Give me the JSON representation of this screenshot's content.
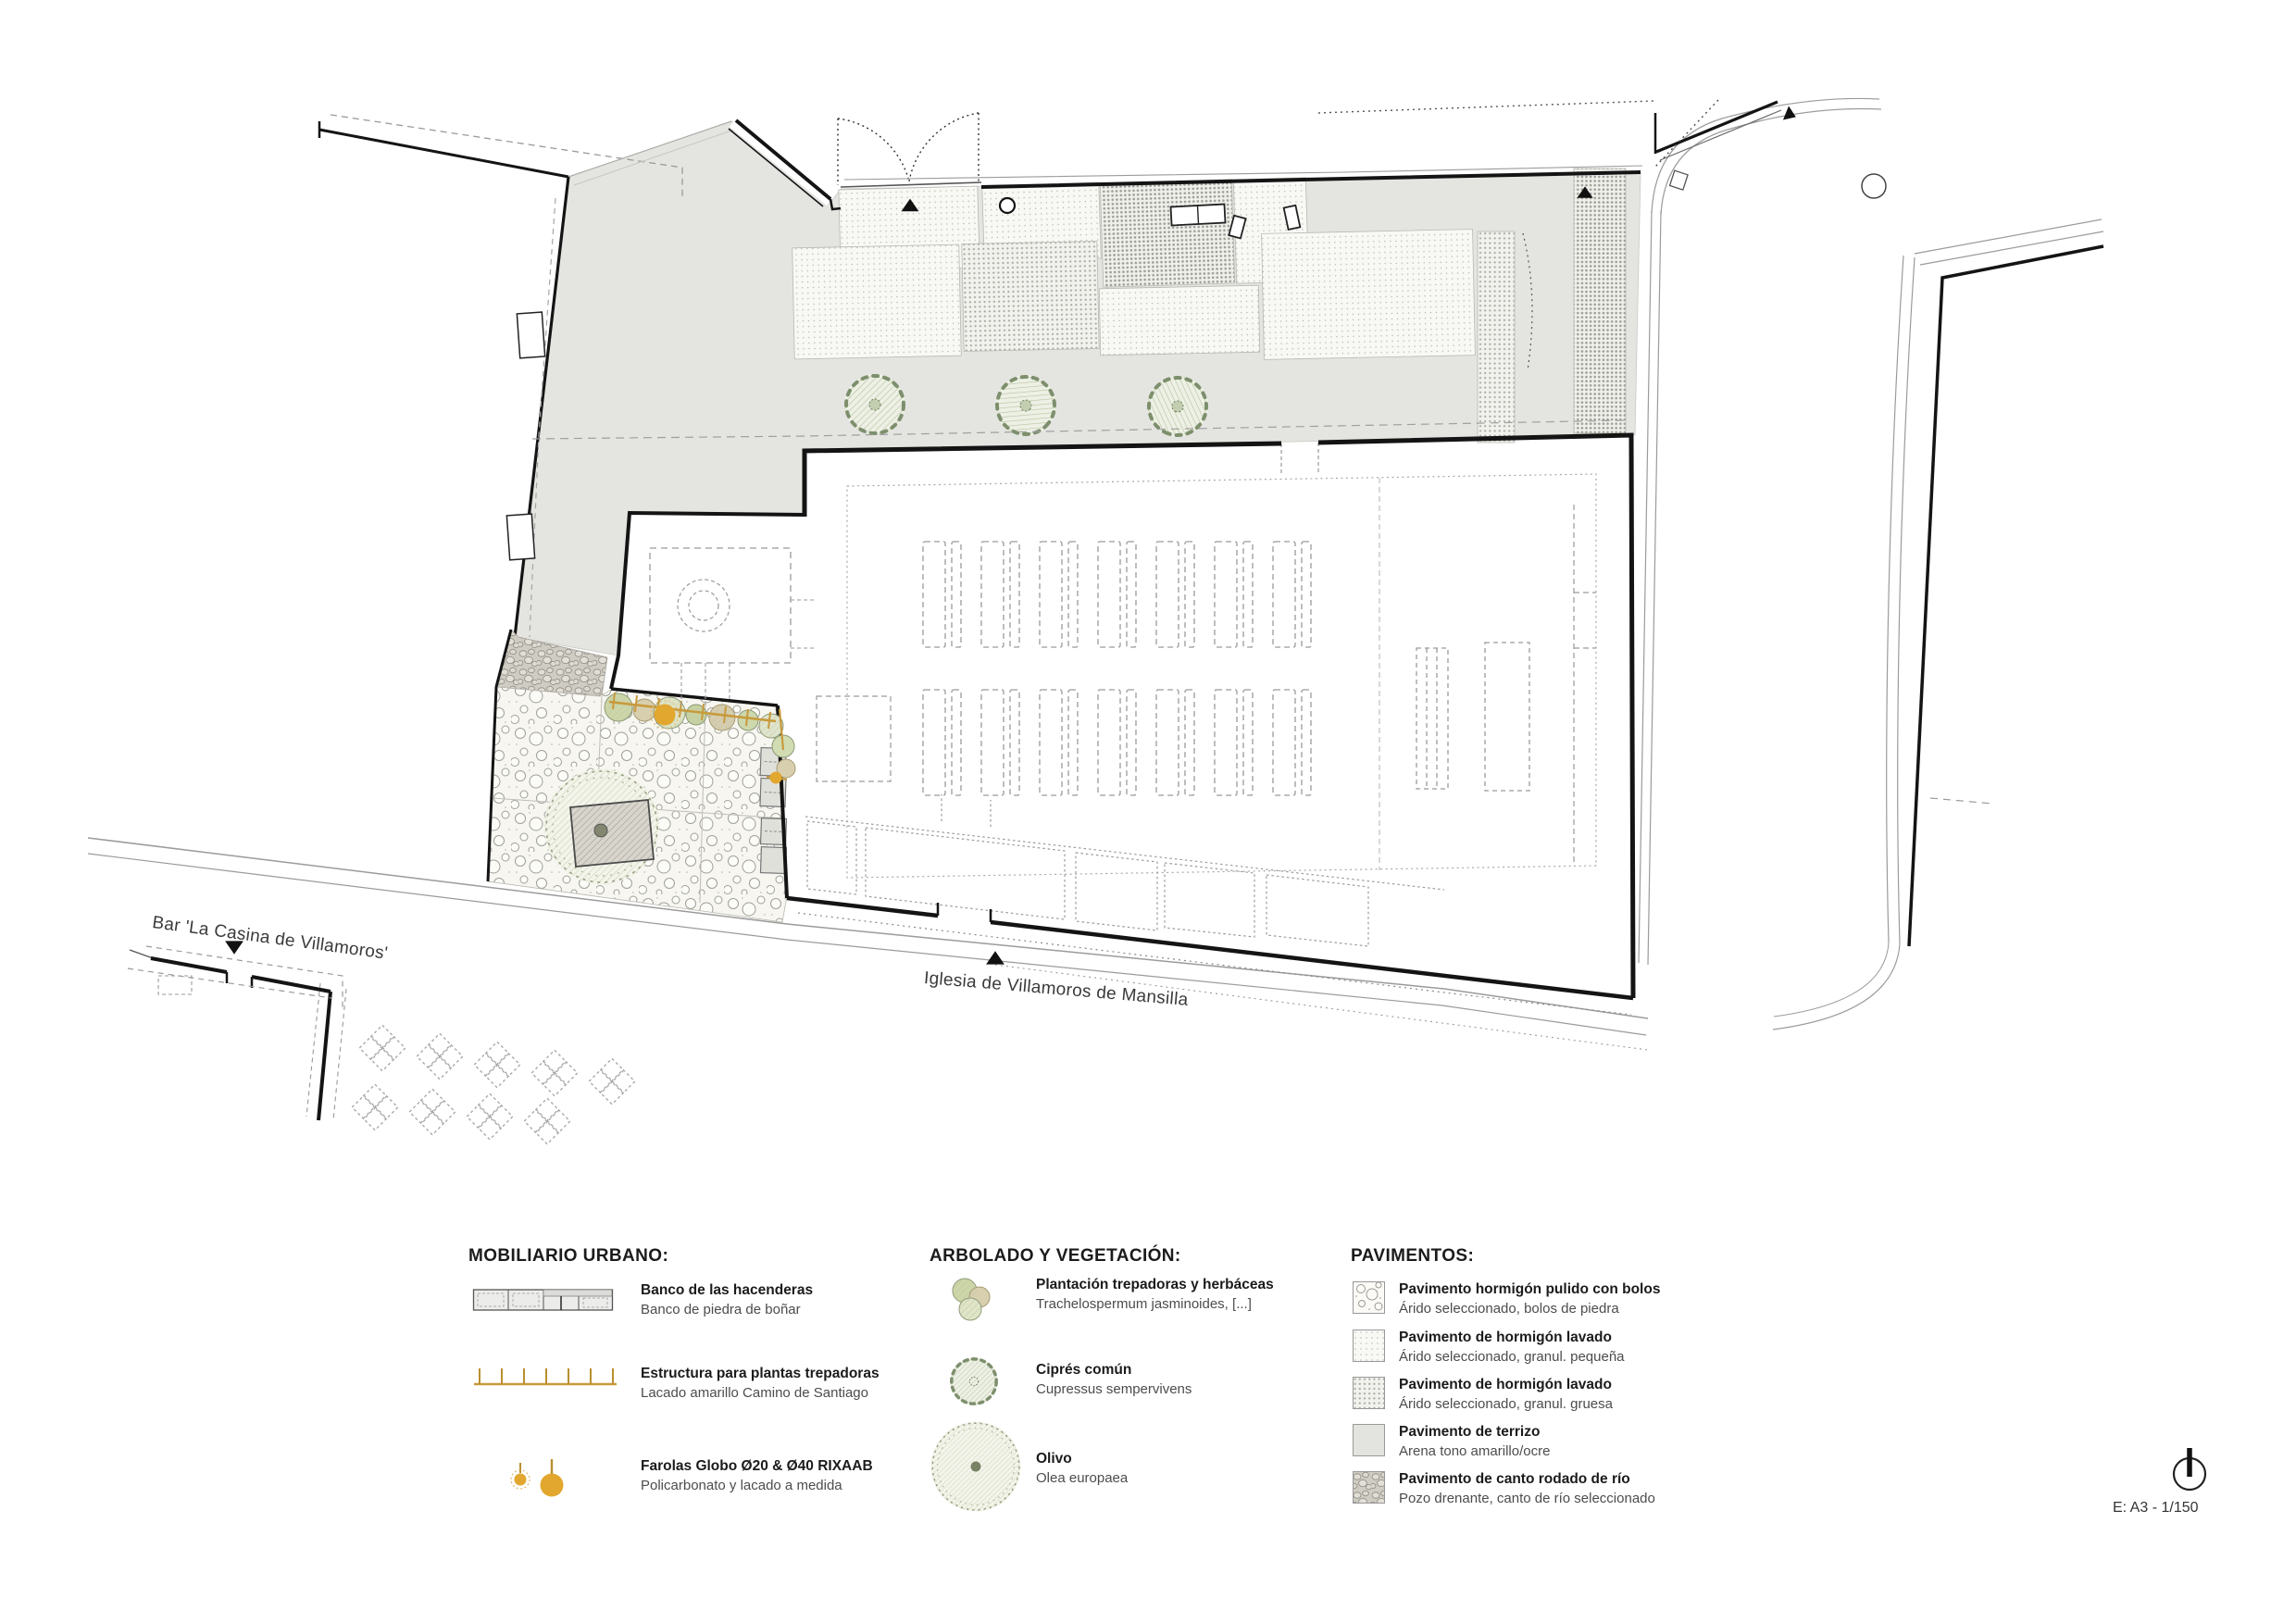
{
  "plan": {
    "labels": {
      "bar": "Bar 'La Casina de Villamoros'",
      "church": "Iglesia de Villamoros de Mansilla"
    },
    "scale_note": "E: A3 - 1/150",
    "features": {
      "church_building": "iglesia planta",
      "pebble_plaza": "plaza canto rodado",
      "courtyard": "atrio pavimentado",
      "bar_building": "bar",
      "north_arrow": "norte"
    }
  },
  "legend": {
    "mobiliario": {
      "title": "MOBILIARIO URBANO:",
      "items": [
        {
          "title": "Banco de las hacenderas",
          "subtitle": "Banco de piedra de boñar",
          "icon": "stone-bench-plan-icon"
        },
        {
          "title": "Estructura para plantas trepadoras",
          "subtitle": "Lacado amarillo Camino de Santiago",
          "icon": "climber-trellis-icon"
        },
        {
          "title": "Farolas Globo Ø20 & Ø40 RIXAAB",
          "subtitle": "Policarbonato y lacado a medida",
          "icon": "globe-lamps-icon"
        }
      ]
    },
    "arbolado": {
      "title": "ARBOLADO Y VEGETACIÓN:",
      "items": [
        {
          "title": "Plantación trepadoras y herbáceas",
          "subtitle": "Trachelospermum jasminoides, [...]",
          "icon": "climber-cluster-icon"
        },
        {
          "title": "Ciprés común",
          "subtitle": "Cupressus sempervivens",
          "icon": "cypress-canopy-icon"
        },
        {
          "title": "Olivo",
          "subtitle": "Olea europaea",
          "icon": "olive-canopy-icon"
        }
      ]
    },
    "pavimentos": {
      "title": "PAVIMENTOS:",
      "items": [
        {
          "title": "Pavimento hormigón pulido con bolos",
          "subtitle": "Árido seleccionado, bolos de piedra",
          "icon": "swatch-bolos"
        },
        {
          "title": "Pavimento de hormigón lavado",
          "subtitle": "Árido seleccionado, granul. pequeña",
          "icon": "swatch-dots-fine"
        },
        {
          "title": "Pavimento de hormigón lavado",
          "subtitle": "Árido seleccionado, granul. gruesa",
          "icon": "swatch-dots-coarse"
        },
        {
          "title": "Pavimento de terrizo",
          "subtitle": "Arena tono amarillo/ocre",
          "icon": "swatch-solid-gray"
        },
        {
          "title": "Pavimento de canto rodado de río",
          "subtitle": "Pozo drenante, canto de río seleccionado",
          "icon": "swatch-pebbles"
        }
      ]
    }
  },
  "colors": {
    "accent_ochre": "#e2a72e",
    "terrizo_gray": "#e4e4e1",
    "wall_black": "#141414",
    "dash_gray": "#9a9a9a",
    "vegetation_green": "#7d8f6d"
  }
}
